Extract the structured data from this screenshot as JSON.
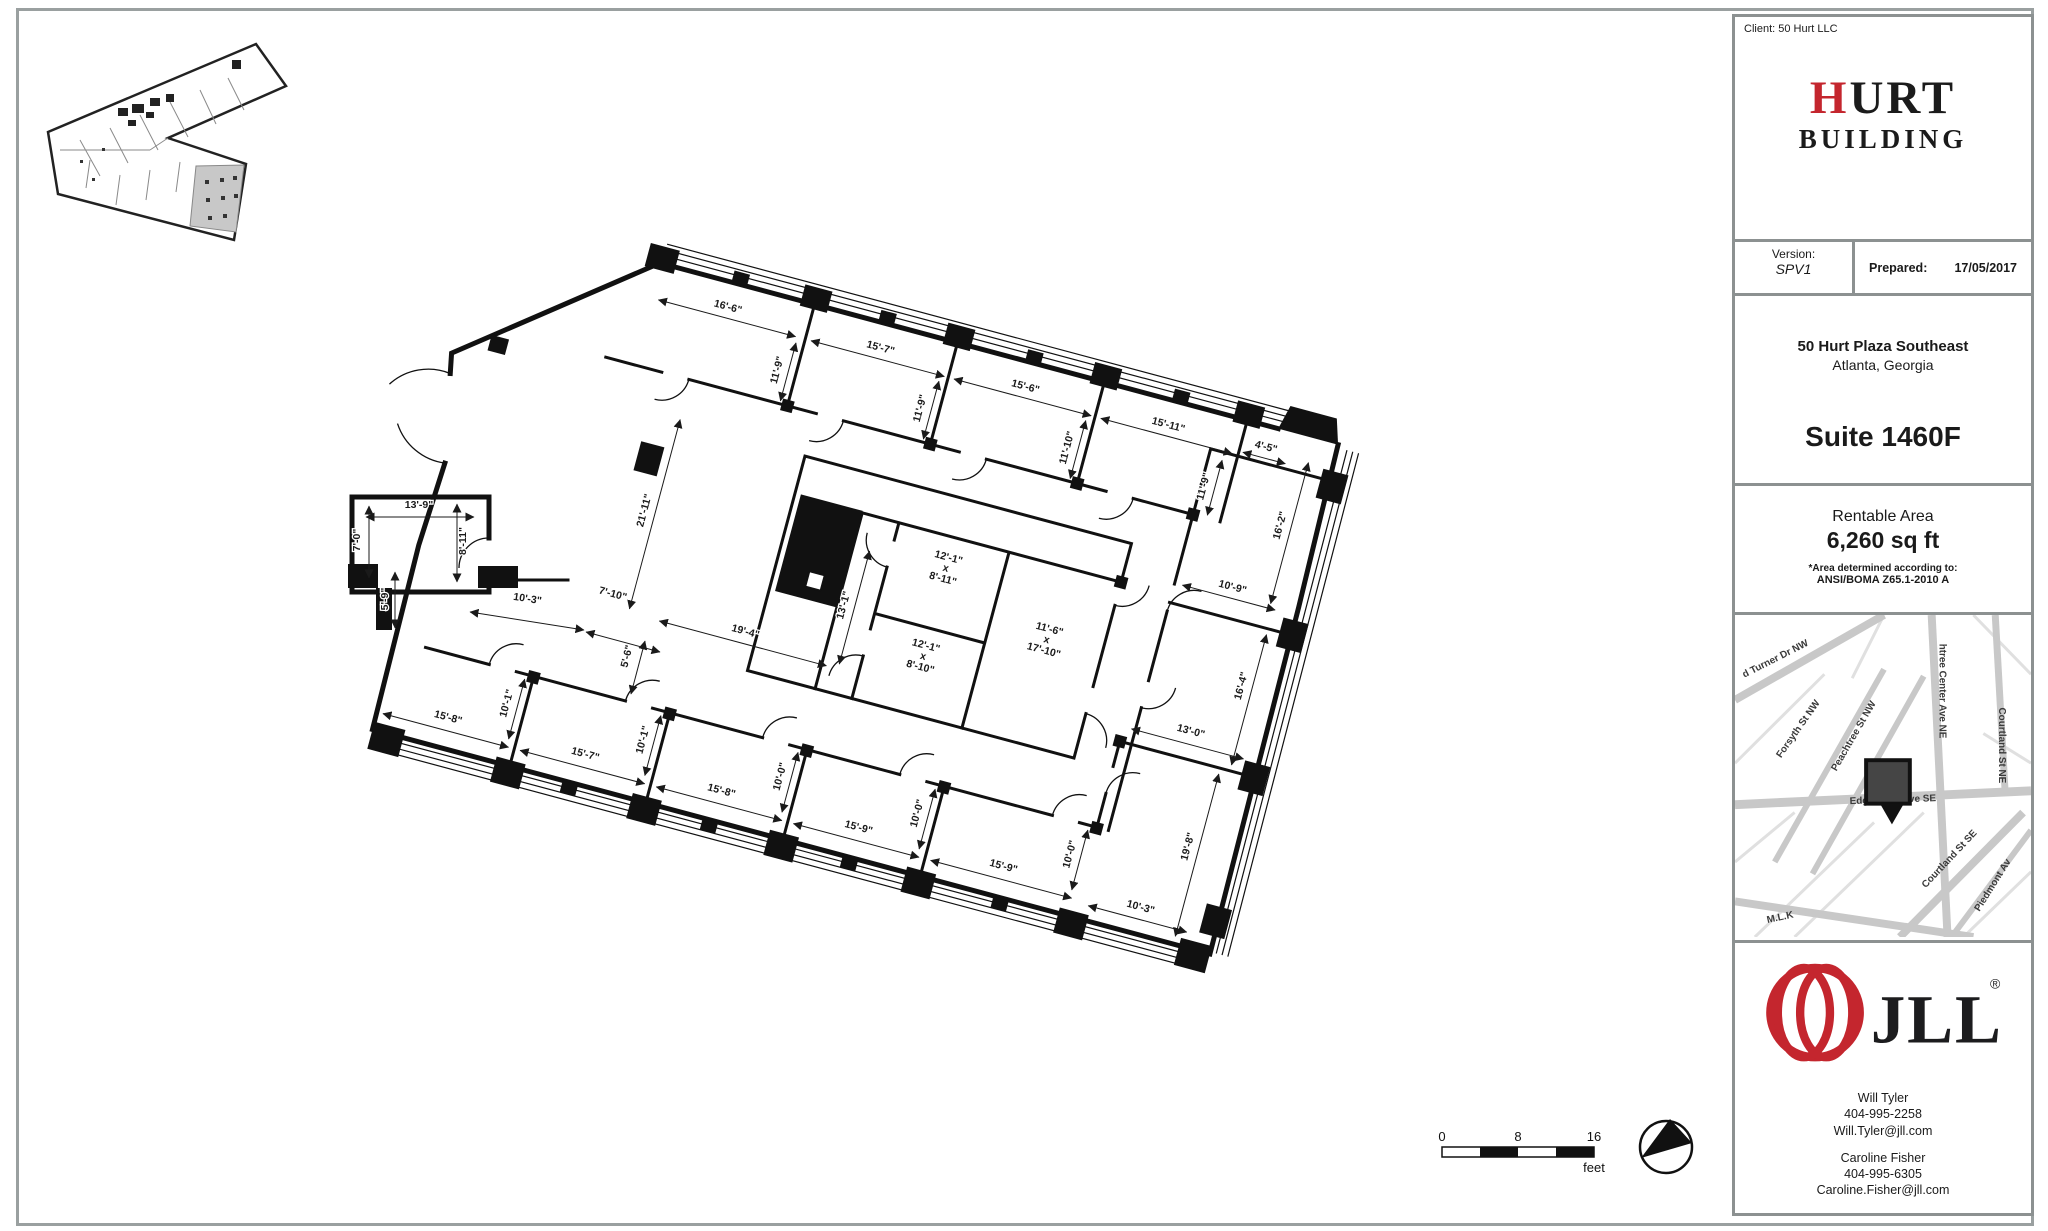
{
  "sidebar": {
    "client_label": "Client: 50 Hurt LLC",
    "logo": {
      "h": "H",
      "urt": "URT",
      "building": "BUILDING"
    },
    "version_label": "Version:",
    "version_value": "SPV1",
    "prepared_label": "Prepared:",
    "prepared_value": "17/05/2017",
    "address_line1": "50 Hurt Plaza Southeast",
    "address_line2": "Atlanta, Georgia",
    "suite": "Suite 1460F",
    "rentable_label": "Rentable Area",
    "rentable_value": "6,260 sq ft",
    "area_note1": "*Area determined according to:",
    "area_note2": "ANSI/BOMA Z65.1-2010 A",
    "map_streets": [
      {
        "t": "d Turner Dr NW",
        "x": 42,
        "y": 47,
        "r": -27
      },
      {
        "t": "Forsyth St NW",
        "x": 66,
        "y": 117,
        "r": -55
      },
      {
        "t": "Peachtree St NW",
        "x": 122,
        "y": 124,
        "r": -60
      },
      {
        "t": "htree Center Ave NE",
        "x": 206,
        "y": 77,
        "r": 90
      },
      {
        "t": "Courtland St NE",
        "x": 266,
        "y": 132,
        "r": 90
      },
      {
        "t": "Edgewood Ave SE",
        "x": 159,
        "y": 190,
        "r": -2
      },
      {
        "t": "Courtland St SE",
        "x": 218,
        "y": 249,
        "r": -47
      },
      {
        "t": "Piedmont Av",
        "x": 262,
        "y": 275,
        "r": -58
      },
      {
        "t": "M.L.K",
        "x": 46,
        "y": 309,
        "r": -12
      }
    ],
    "jll": {
      "logo_text": "JLL",
      "reg": "®",
      "contacts": [
        {
          "name": "Will Tyler",
          "phone": "404-995-2258",
          "email": "Will.Tyler@jll.com"
        },
        {
          "name": "Caroline Fisher",
          "phone": "404-995-6305",
          "email": "Caroline.Fisher@jll.com"
        }
      ]
    }
  },
  "plan": {
    "scale": {
      "ticks": [
        "0",
        "8",
        "16"
      ],
      "unit": "feet"
    },
    "dims_plan": [
      {
        "t": "16'-6\"",
        "x": 737,
        "y": 291,
        "r": 0,
        "l": [
          668,
          299,
          810,
          299
        ]
      },
      {
        "t": "15'-7\"",
        "x": 895,
        "y": 291,
        "r": 0,
        "l": [
          826,
          299,
          964,
          299
        ]
      },
      {
        "t": "15'-6\"",
        "x": 1045,
        "y": 291,
        "r": 0,
        "l": [
          974,
          299,
          1116,
          299
        ]
      },
      {
        "t": "15'-11\"",
        "x": 1193,
        "y": 291,
        "r": 0,
        "l": [
          1126,
          299,
          1262,
          299
        ]
      },
      {
        "t": "4'-5\"",
        "x": 1293,
        "y": 287,
        "r": 0,
        "l": [
          1272,
          295,
          1316,
          295
        ]
      },
      {
        "t": "11'-9\"",
        "x": 804,
        "y": 336,
        "r": -90,
        "l": [
          812,
          305,
          812,
          365
        ]
      },
      {
        "t": "11'-9\"",
        "x": 952,
        "y": 336,
        "r": -90,
        "l": [
          960,
          305,
          960,
          365
        ]
      },
      {
        "t": "11'-10\"",
        "x": 1104,
        "y": 336,
        "r": -90,
        "l": [
          1112,
          305,
          1112,
          365
        ]
      },
      {
        "t": "11'-9\"",
        "x": 1246,
        "y": 338,
        "r": -90,
        "l": [
          1254,
          308,
          1254,
          365
        ]
      },
      {
        "t": "16'-2\"",
        "x": 1330,
        "y": 356,
        "r": -90,
        "l": [
          1338,
          288,
          1338,
          434
        ]
      },
      {
        "t": "10'-9\"",
        "x": 1297,
        "y": 431,
        "r": 0,
        "l": [
          1248,
          439,
          1344,
          439
        ]
      },
      {
        "t": "16'-4\"",
        "x": 1334,
        "y": 521,
        "r": -90,
        "l": [
          1342,
          465,
          1342,
          600
        ]
      },
      {
        "t": "13'-0\"",
        "x": 1294,
        "y": 581,
        "r": 0,
        "l": [
          1236,
          591,
          1352,
          591
        ]
      },
      {
        "t": "19'-8\"",
        "x": 1324,
        "y": 690,
        "r": -90,
        "l": [
          1332,
          612,
          1332,
          780
        ]
      },
      {
        "t": "10'-3\"",
        "x": 1291,
        "y": 764,
        "r": 0,
        "l": [
          1240,
          773,
          1342,
          773
        ]
      },
      {
        "t": "15'-8\"",
        "x": 573,
        "y": 760,
        "r": 0,
        "l": [
          509,
          770,
          639,
          770
        ]
      },
      {
        "t": "15'-7\"",
        "x": 715,
        "y": 760,
        "r": 0,
        "l": [
          651,
          770,
          780,
          770
        ]
      },
      {
        "t": "15'-8\"",
        "x": 856,
        "y": 760,
        "r": 0,
        "l": [
          792,
          770,
          922,
          770
        ]
      },
      {
        "t": "15'-9\"",
        "x": 998,
        "y": 760,
        "r": 0,
        "l": [
          934,
          770,
          1064,
          770
        ]
      },
      {
        "t": "15'-9\"",
        "x": 1148,
        "y": 760,
        "r": 0,
        "l": [
          1076,
          770,
          1222,
          770
        ]
      },
      {
        "t": "10'-1\"",
        "x": 629,
        "y": 728,
        "r": -90,
        "l": [
          637,
          700,
          637,
          762
        ]
      },
      {
        "t": "10'-1\"",
        "x": 770,
        "y": 728,
        "r": -90,
        "l": [
          778,
          700,
          778,
          762
        ]
      },
      {
        "t": "10'-0\"",
        "x": 912,
        "y": 728,
        "r": -90,
        "l": [
          920,
          700,
          920,
          762
        ]
      },
      {
        "t": "10'-0\"",
        "x": 1054,
        "y": 728,
        "r": -90,
        "l": [
          1062,
          700,
          1062,
          762
        ]
      },
      {
        "t": "10'-0\"",
        "x": 1212,
        "y": 728,
        "r": -90,
        "l": [
          1220,
          700,
          1220,
          762
        ]
      },
      {
        "t": "21'-11\"",
        "x": 712,
        "y": 506,
        "r": -90,
        "l": [
          720,
          409,
          720,
          605
        ]
      },
      {
        "t": "19'-4\"",
        "x": 838,
        "y": 600,
        "r": 0,
        "l": [
          752,
          609,
          925,
          609
        ]
      },
      {
        "t": "13'-1\"",
        "x": 929,
        "y": 546,
        "r": -90,
        "l": [
          937,
          487,
          937,
          604
        ]
      }
    ],
    "dims_page": [
      {
        "t": "13'-9\"",
        "x": 419,
        "y": 508,
        "r": 0,
        "l": [
          366,
          517,
          474,
          517
        ]
      },
      {
        "t": "7'-0\"",
        "x": 360,
        "y": 540,
        "r": -90,
        "l": [
          369,
          506,
          369,
          578
        ]
      },
      {
        "t": "8'-11\"",
        "x": 466,
        "y": 541,
        "r": -90,
        "l": [
          457,
          504,
          457,
          582
        ]
      },
      {
        "t": "5'-9\"",
        "x": 388,
        "y": 599,
        "r": -90,
        "l": [
          395,
          572,
          395,
          628
        ]
      },
      {
        "t": "10'-3\"",
        "x": 527,
        "y": 602,
        "r": 9,
        "l": [
          470,
          612,
          584,
          630
        ]
      },
      {
        "t": "7'-10\"",
        "x": 612,
        "y": 597,
        "r": 15,
        "l": [
          586,
          632,
          660,
          652
        ]
      },
      {
        "t": "5'-6\"",
        "x": 630,
        "y": 657,
        "r": -76,
        "l": [
          645,
          641,
          631,
          694
        ]
      }
    ],
    "rooms": [
      {
        "lines": [
          "12'-1\"",
          "x",
          "8'-11\""
        ],
        "x": 1015,
        "y": 487
      },
      {
        "lines": [
          "12'-1\"",
          "x",
          "8'-10\""
        ],
        "x": 1016,
        "y": 578
      },
      {
        "lines": [
          "11'-6\"",
          "x",
          "17'-10\""
        ],
        "x": 1131,
        "y": 530
      }
    ]
  },
  "colors": {
    "accent_red": "#c4262e",
    "wall": "#111111",
    "road": "#c8c8c8"
  }
}
